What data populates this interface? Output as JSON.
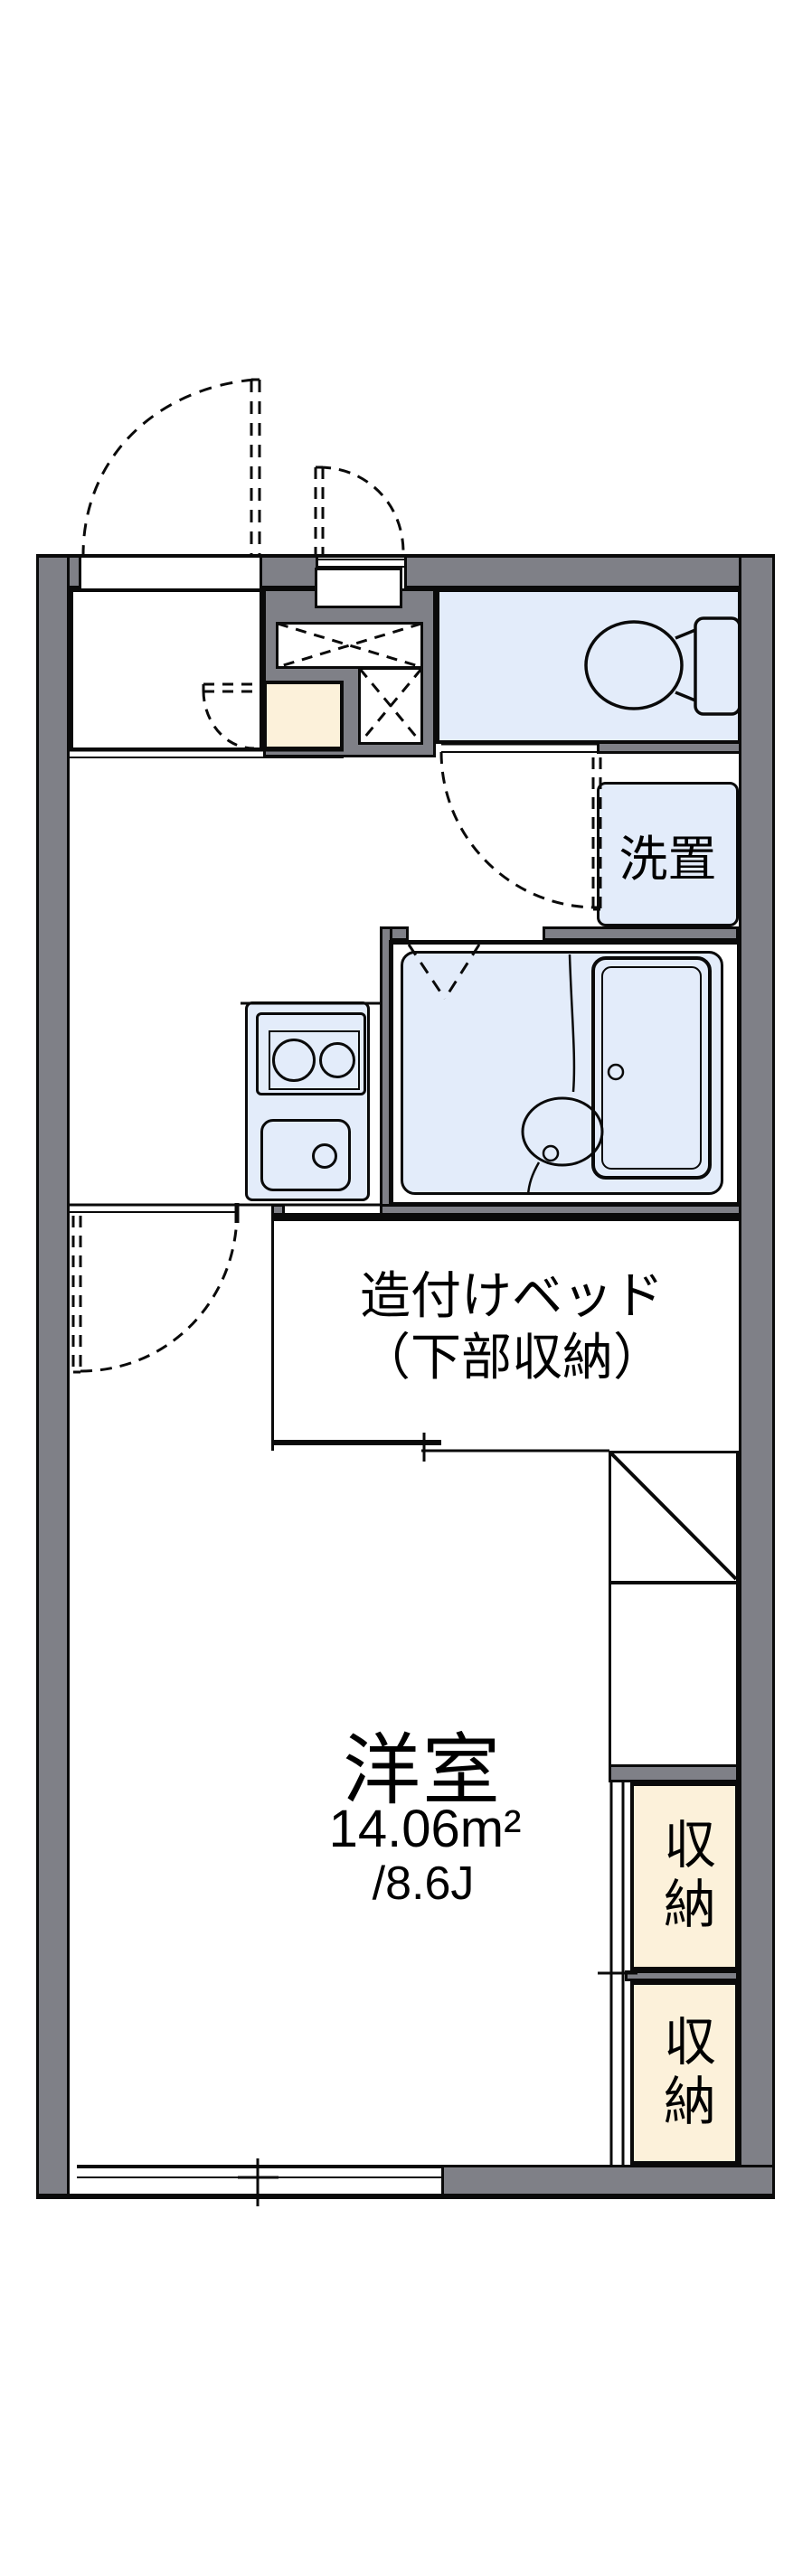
{
  "plan_title": "1K apartment floor plan",
  "labels": {
    "laundry": "洗置",
    "bed_line1": "造付けベッド",
    "bed_line2": "（下部収納）",
    "room_name": "洋室",
    "room_area_m2": "14.06m²",
    "room_area_jo": "/8.6J",
    "storage1": "収納",
    "storage2": "収納"
  },
  "rooms": {
    "western_room": {
      "name": "洋室",
      "area_m2": "14.06",
      "area_jo": "8.6"
    },
    "built_in_bed": {
      "name": "造付けベッド（下部収納）"
    },
    "laundry_space": {
      "name": "洗置"
    },
    "closets": [
      "収納",
      "収納"
    ]
  },
  "fixtures": [
    "toilet",
    "bathtub",
    "wash-basin",
    "two-burner-stove",
    "kitchen-sink",
    "entrance-door-swing",
    "storage-door-swing",
    "toilet-door-swing",
    "room-door-swing",
    "folding-bath-door",
    "refrigerator-space",
    "sliding-window",
    "closet-sliding-door",
    "upper-storage-dashed-x"
  ],
  "colors": {
    "wall": "#7f8087",
    "line": "#0a0a0a",
    "water_area": "#e3ecfa",
    "storage_cream": "#fcf1da",
    "background": "#ffffff"
  }
}
